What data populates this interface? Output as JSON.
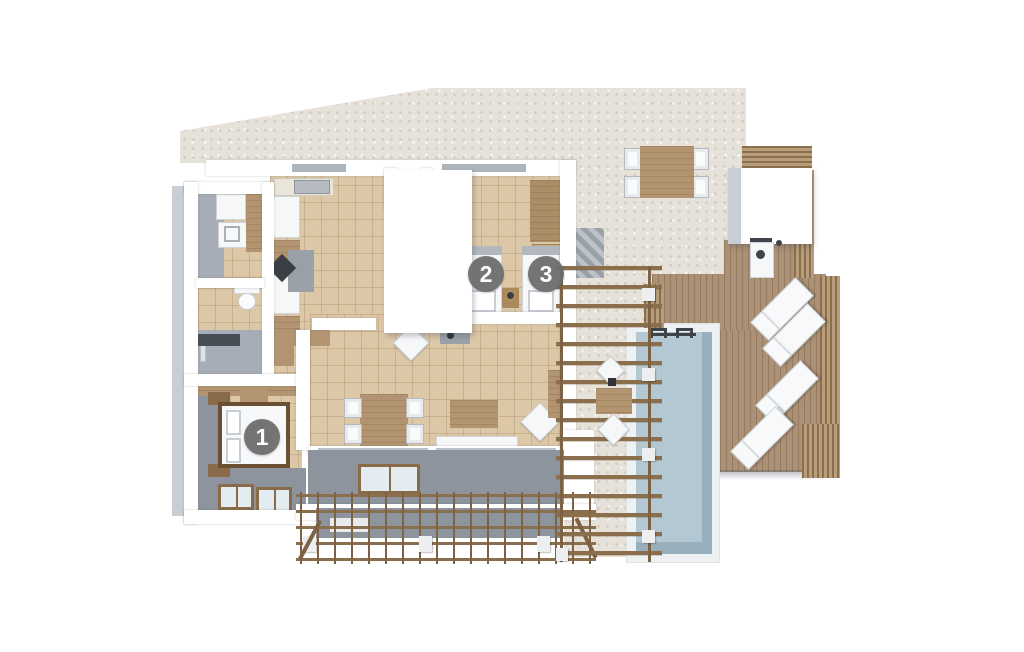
{
  "title": "villa-floor-plan-3d",
  "markers": [
    {
      "id": "1",
      "label": "1"
    },
    {
      "id": "2",
      "label": "2"
    },
    {
      "id": "3",
      "label": "3"
    }
  ],
  "palette": {
    "stone": "#e7e2d9",
    "tile": "#dcc7a7",
    "wall": "#ffffff",
    "terrace_gray": "#8d949e",
    "pool_water": "#b4c8d3",
    "pool_rim": "#eef1f2",
    "deck_wood": "#ab9175",
    "pergola_wood": "#8b6f4d",
    "furn_wood": "#b29470",
    "marker_bg": "#6d6d6d",
    "marker_text": "#ffffff"
  }
}
